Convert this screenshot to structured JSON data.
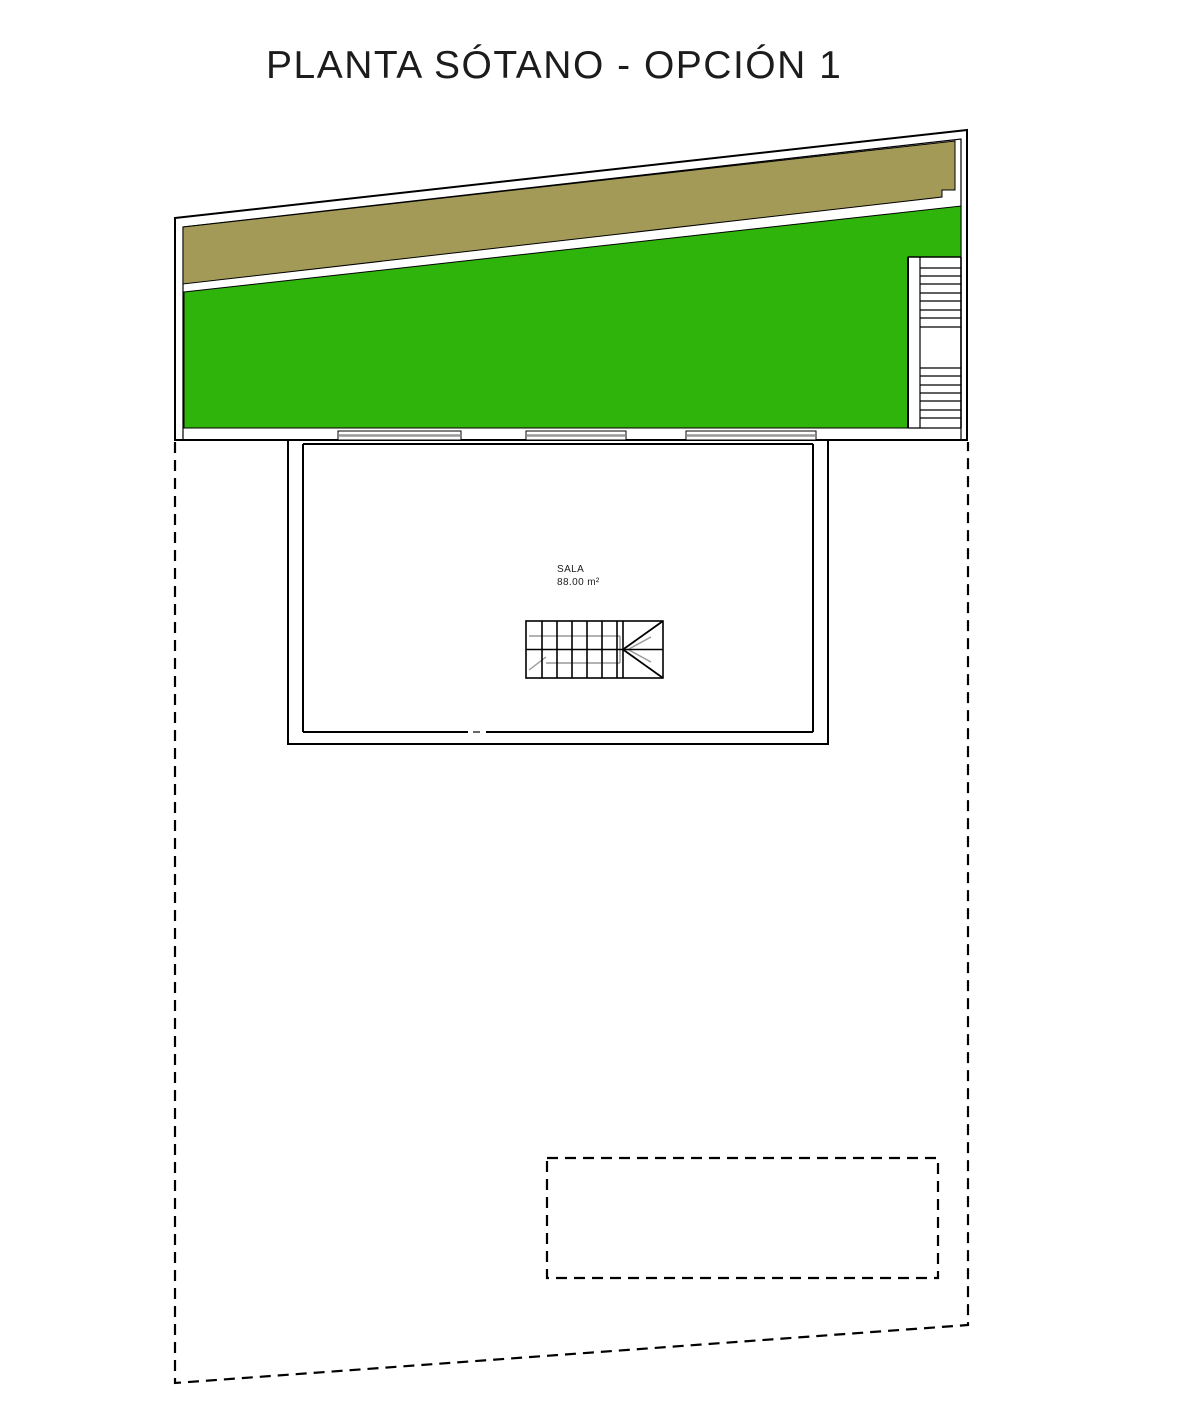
{
  "title": "PLANTA SÓTANO - OPCIÓN 1",
  "plan": {
    "room": {
      "label": "SALA",
      "area": "88.00 m²"
    }
  },
  "colors": {
    "grass_green": "#2FB40C",
    "terrain_brown": "#A39A58",
    "line_black": "#000000",
    "detail_gray": "#999999"
  }
}
